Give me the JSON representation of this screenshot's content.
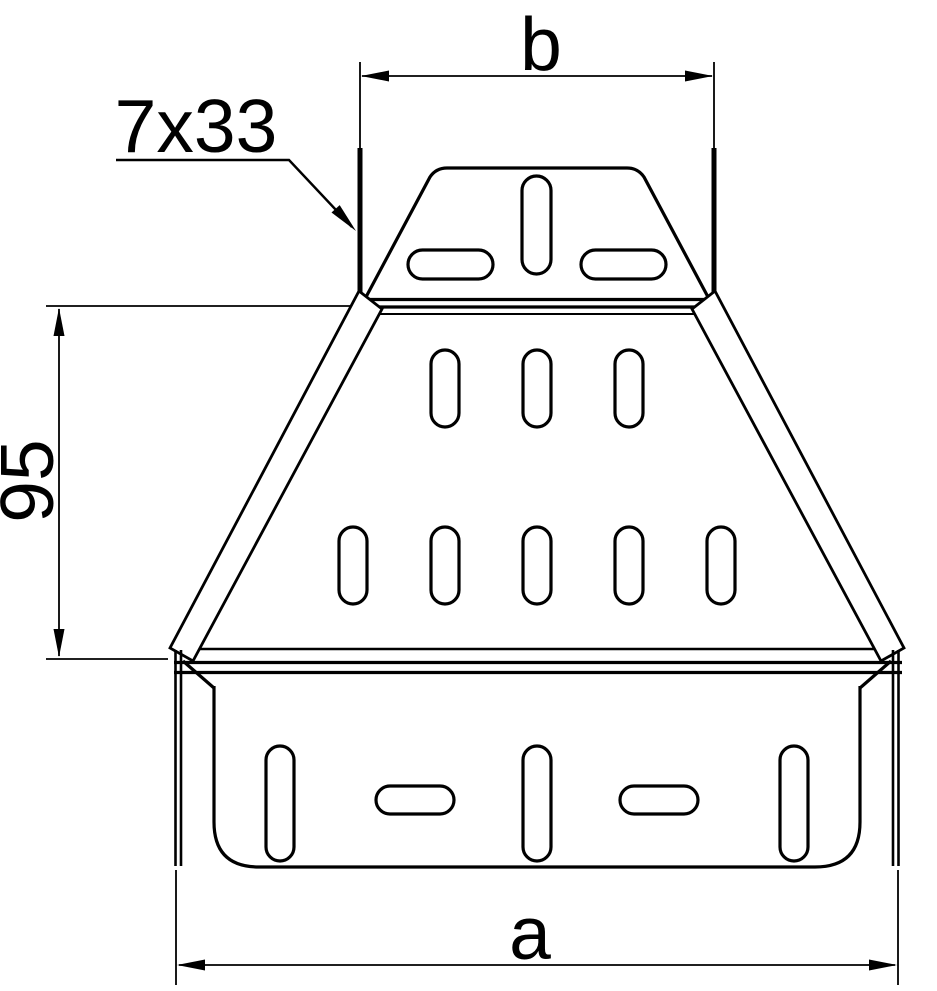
{
  "drawing": {
    "labels": {
      "dim_top_width": "b",
      "dim_bottom_width": "a",
      "dim_side_height": "95",
      "slot_callout": "7x33"
    },
    "colors": {
      "line": "#000000",
      "background": "#ffffff"
    }
  }
}
